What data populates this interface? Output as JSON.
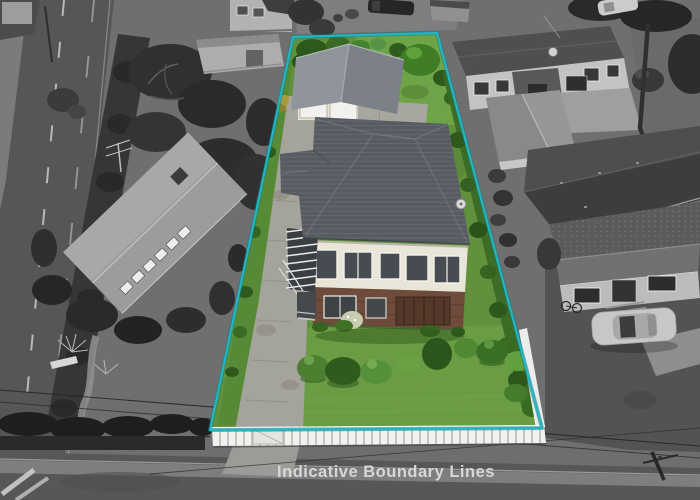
{
  "caption": {
    "text": "Indicative Boundary Lines",
    "color": "#dcdcdc"
  },
  "boundary": {
    "points": "293,37 437,33 542,428 210,430",
    "line_color": "#23b5c0",
    "line_color_dark": "#0d7d88"
  },
  "palette": {
    "background_gray": "#6f6f6f",
    "road_asphalt": "#565656",
    "lawn_green": "#61913c",
    "front_lawn_green": "#6a9c44",
    "house_roof_gray": "#575c63",
    "house_wall_cream": "#e9e5d8",
    "house_brick": "#6e4b3b",
    "garage_roof_gray": "#8f959b",
    "fence_white": "#f1f1f0"
  }
}
